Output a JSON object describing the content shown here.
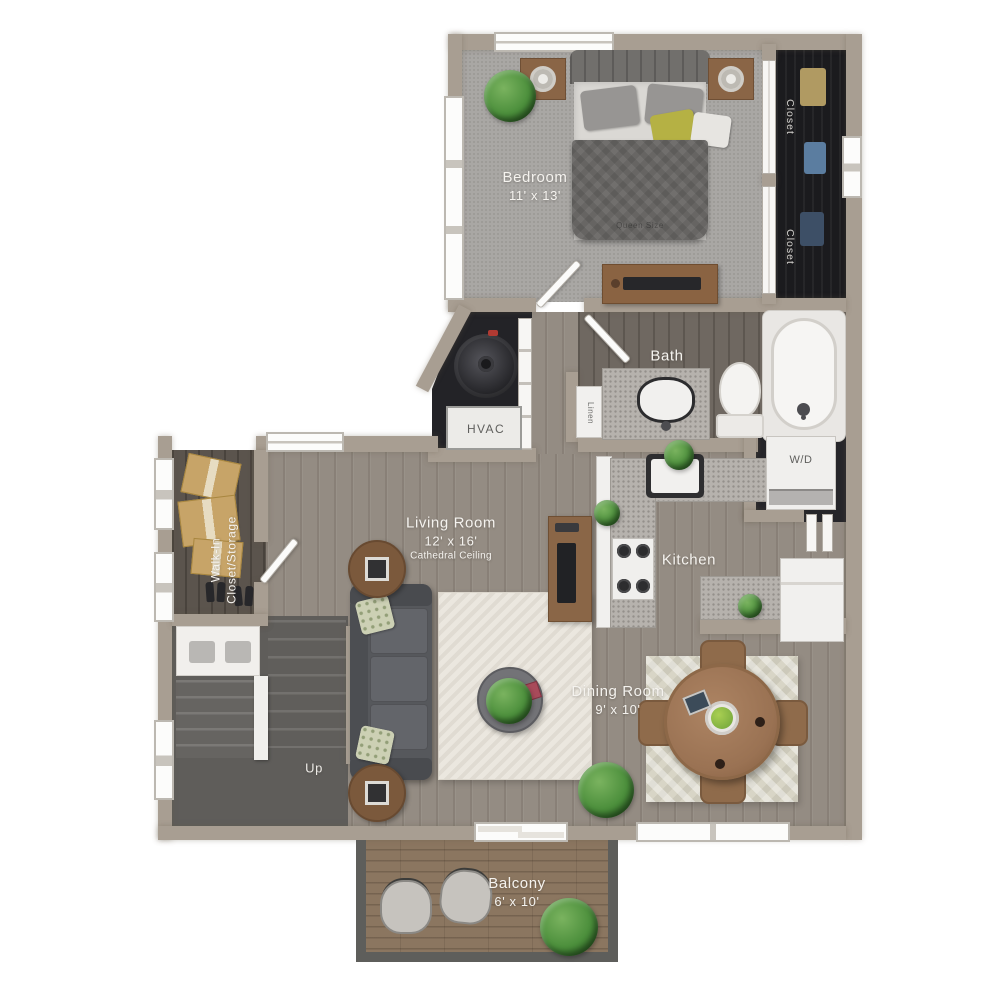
{
  "labels": {
    "bedroom": {
      "name": "Bedroom",
      "dims": "11' x 13'"
    },
    "bed": {
      "name": "Queen Size"
    },
    "closet_upper": {
      "name": "Closet"
    },
    "closet_lower": {
      "name": "Closet"
    },
    "bath": {
      "name": "Bath"
    },
    "linen": {
      "name": "Linen"
    },
    "hvac": {
      "name": "HVAC"
    },
    "laundry": {
      "name": "W/D"
    },
    "kitchen": {
      "name": "Kitchen"
    },
    "living_room": {
      "name": "Living Room",
      "dims": "12' x 16'",
      "note": "Cathedral Ceiling"
    },
    "walk_in_closet": {
      "line1": "Walk-In",
      "line2": "Closet/Storage"
    },
    "stairs": {
      "name": "Up"
    },
    "dining_room": {
      "name": "Dining Room",
      "dims": "9' x 10'"
    },
    "balcony": {
      "name": "Balcony",
      "dims": "6' x 10'"
    }
  },
  "colors": {
    "wall": "#a89e92",
    "carpet": "#a9a7a4",
    "wood_floor": "#948c83",
    "wood_floor_dark": "#6f6861",
    "closet_interior": "#1b1b1e",
    "stairs_carpet": "#5f5d5a",
    "balcony_deck": "#8b7660",
    "granite_counter": "#b6b2ad",
    "white_fixture": "#f1f0ee",
    "living_rug": "#ebe7df",
    "dining_rug": "#d8d5c6",
    "sofa": "#56585c",
    "wood_furniture": "#8a6647",
    "accent_pillow": "#b5b144",
    "plant": "#4c8f3c",
    "label_text": "#f5f3ef"
  }
}
